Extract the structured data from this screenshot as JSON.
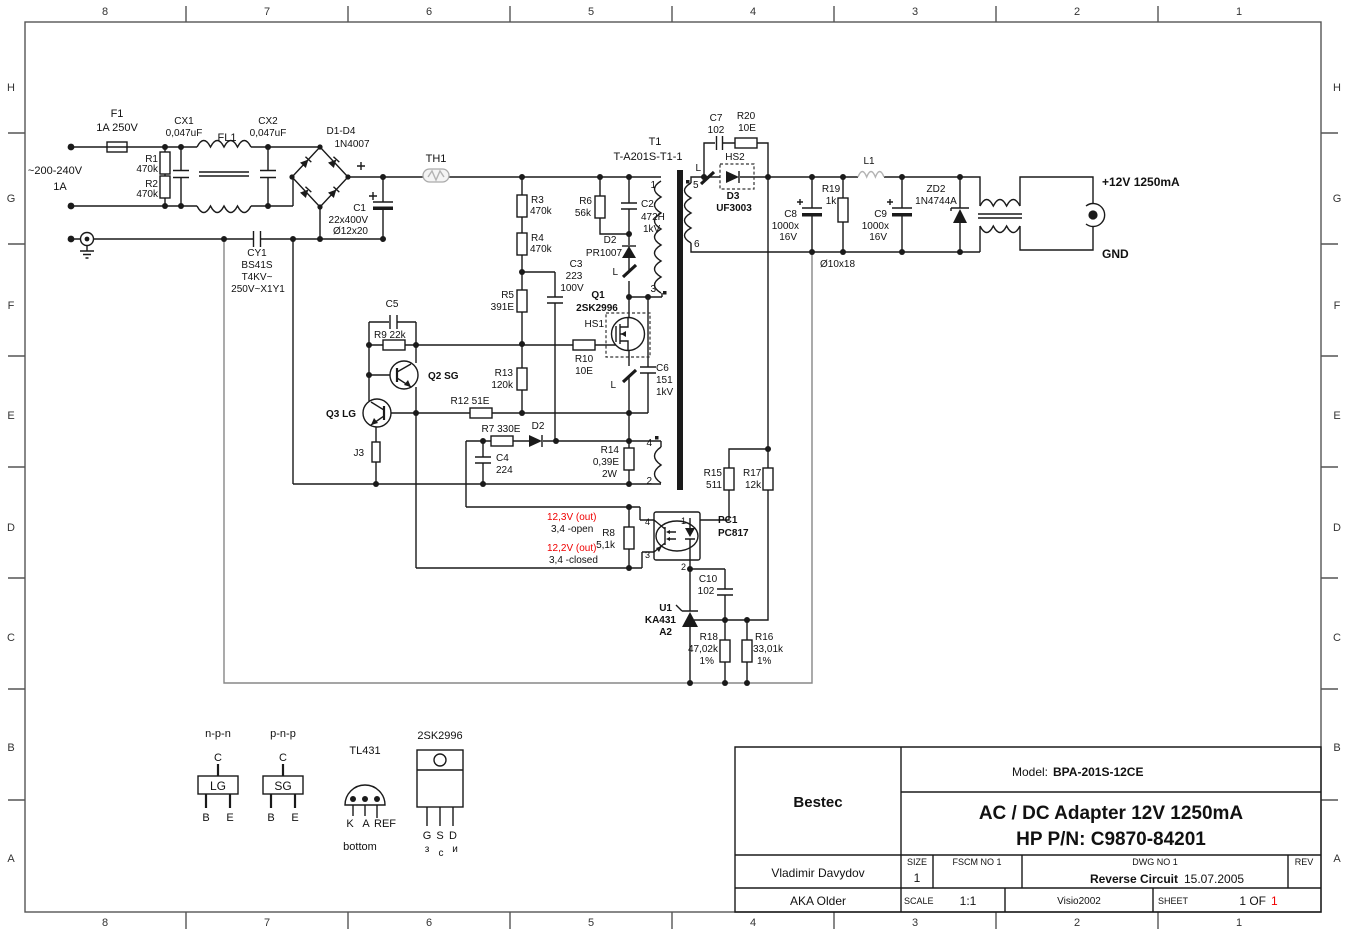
{
  "colors": {
    "wire": "#1a1a1a",
    "ground_net": "#878787",
    "annotation_red": "#f00000",
    "thermistor_gray": "#b3b3b3"
  },
  "border": {
    "cols": [
      "8",
      "7",
      "6",
      "5",
      "4",
      "3",
      "2",
      "1"
    ],
    "rows": [
      "H",
      "G",
      "F",
      "E",
      "D",
      "C",
      "B",
      "A"
    ]
  },
  "src": {
    "v": "~200-240V",
    "a": "1A"
  },
  "c": {
    "f1": "F1",
    "f1v": "1A 250V",
    "r1": "R1",
    "r1v": "470k",
    "r2": "R2",
    "r2v": "470k",
    "cx1": "CX1",
    "cx1v": "0,047uF",
    "fl1": "FL1",
    "cx2": "CX2",
    "cx2v": "0,047uF",
    "br": "D1-D4",
    "brv": "1N4007",
    "th1": "TH1",
    "c1": "C1",
    "c1v1": "22x400V",
    "c1v2": "Ø12x20",
    "cy1": "CY1",
    "cy1v1": "BS41S",
    "cy1v2": "T4KV~",
    "cy1v3": "250V~X1Y1",
    "r3": "R3",
    "r3v": "470k",
    "r4": "R4",
    "r4v": "470k",
    "r5": "R5",
    "r5v": "391E",
    "r6": "R6",
    "r6v": "56k",
    "c2": "C2",
    "c2v1": "472H",
    "c2v2": "1kV",
    "d2a": "D2",
    "d2av": "PR1007",
    "c3": "C3",
    "c3v1": "223",
    "c3v2": "100V",
    "q1": "Q1",
    "q1v": "2SK2996",
    "hs1": "HS1",
    "r10": "R10",
    "r10v": "10E",
    "r13": "R13",
    "r13v": "120k",
    "c6": "C6",
    "c6v1": "151",
    "c6v2": "1kV",
    "c5": "C5",
    "r9": "R9 22k",
    "q2": "Q2 SG",
    "q3": "Q3 LG",
    "j3": "J3",
    "r12": "R12 51E",
    "r7": "R7 330E",
    "d2b": "D2",
    "c4": "C4",
    "c4v": "224",
    "r14": "R14",
    "r14v1": "0,39E",
    "r14v2": "2W",
    "t1": "T1",
    "t1v": "T-A201S-T1-1",
    "p1": "1",
    "p2": "2",
    "p3": "3",
    "p4": "4",
    "p5": "5",
    "p6": "6",
    "lm": "L",
    "c7": "C7",
    "c7v": "102",
    "r20": "R20",
    "r20v": "10E",
    "hs2": "HS2",
    "d3": "D3",
    "d3v": "UF3003",
    "c8": "C8",
    "c8v1": "1000x",
    "c8v2": "16V",
    "r19": "R19",
    "r19v": "1k",
    "c9": "C9",
    "c9v1": "1000x",
    "c9v2": "16V",
    "l1": "L1",
    "zd2": "ZD2",
    "zd2v": "1N4744A",
    "dia": "Ø10x18",
    "outv": "+12V 1250mA",
    "outg": "GND",
    "r15": "R15",
    "r15v": "511",
    "r17": "R17",
    "r17v": "12k",
    "pc1": "PC1",
    "pc1v": "PC817",
    "pp1": "1",
    "pp2": "2",
    "pp3": "3",
    "pp4": "4",
    "r8": "R8",
    "r8v": "5,1k",
    "c10": "C10",
    "c10v": "102",
    "u1": "U1",
    "u1v1": "KA431",
    "u1v2": "A2",
    "r18": "R18",
    "r18v1": "47,02k",
    "r18v2": "1%",
    "r16": "R16",
    "r16v1": "33,01k",
    "r16v2": "1%"
  },
  "notes": {
    "n1": "12,3V (out)",
    "n2": "3,4 -open",
    "n3": "12,2V (out)",
    "n4": "3,4 -closed"
  },
  "lg": {
    "npn": "n-p-n",
    "pnp": "p-n-p",
    "cpin": "C",
    "bpin": "B",
    "epin": "E",
    "lgbox": "LG",
    "sgbox": "SG",
    "tl": "TL431",
    "k": "K",
    "a": "A",
    "ref": "REF",
    "bottom": "bottom",
    "fet": "2SK2996",
    "g": "G",
    "s": "S",
    "d": "D",
    "zg": "з",
    "zs": "с",
    "zd": "и"
  },
  "tb": {
    "company": "Bestec",
    "model_l": "Model:",
    "model": "BPA-201S-12CE",
    "t1": "AC / DC Adapter 12V 1250mA",
    "t2": "HP P/N: C9870-84201",
    "author": "Vladimir Davydov",
    "alias": "AKA Older",
    "size_l": "SIZE",
    "size": "1",
    "fscm": "FSCM NO 1",
    "dwg": "DWG NO 1",
    "dwg_name": "Reverse Circuit",
    "dwg_date": "15.07.2005",
    "rev": "REV",
    "scale_l": "SCALE",
    "scale": "1:1",
    "sw": "Visio2002",
    "sheet_l": "SHEET",
    "sheet": "1 OF",
    "sheet_red": "1"
  }
}
